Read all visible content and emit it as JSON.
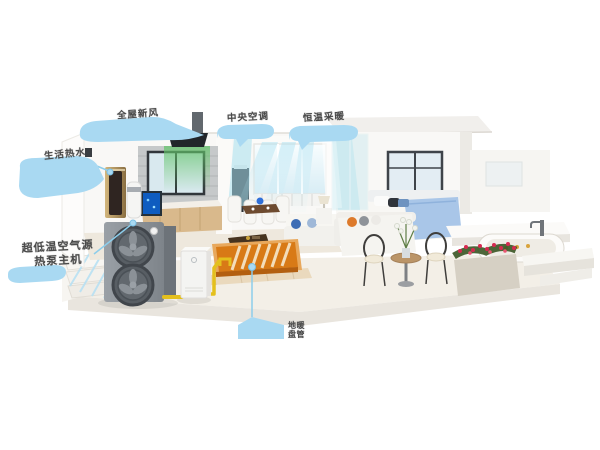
{
  "scene": {
    "description": "3D cutaway render of a single-storey home showing an air-source heat pump whole-house system with callout annotations",
    "colors": {
      "callout_blue": "#a9d9f2",
      "connector_blue": "#8ccdeb",
      "pipe_yellow": "#e4c01d",
      "floor_heating_orange": "#d87a16",
      "airflow_cyan": "#9fdcef",
      "fresh_air_green": "#63c46a",
      "label_text": "#4a4a4a",
      "outdoor_unit_gray": "#8b9197"
    }
  },
  "callouts": {
    "fresh_air": {
      "label": "全屋新风"
    },
    "central_ac": {
      "label": "中央空调"
    },
    "heating": {
      "label": "恒温采暖"
    },
    "hot_water": {
      "label": "生活热水"
    },
    "heat_pump": {
      "label_line1": "超低温空气源",
      "label_line2": "热泵主机"
    },
    "floor_heating": {
      "label_line1": "地暖",
      "label_line2": "盘管"
    }
  }
}
